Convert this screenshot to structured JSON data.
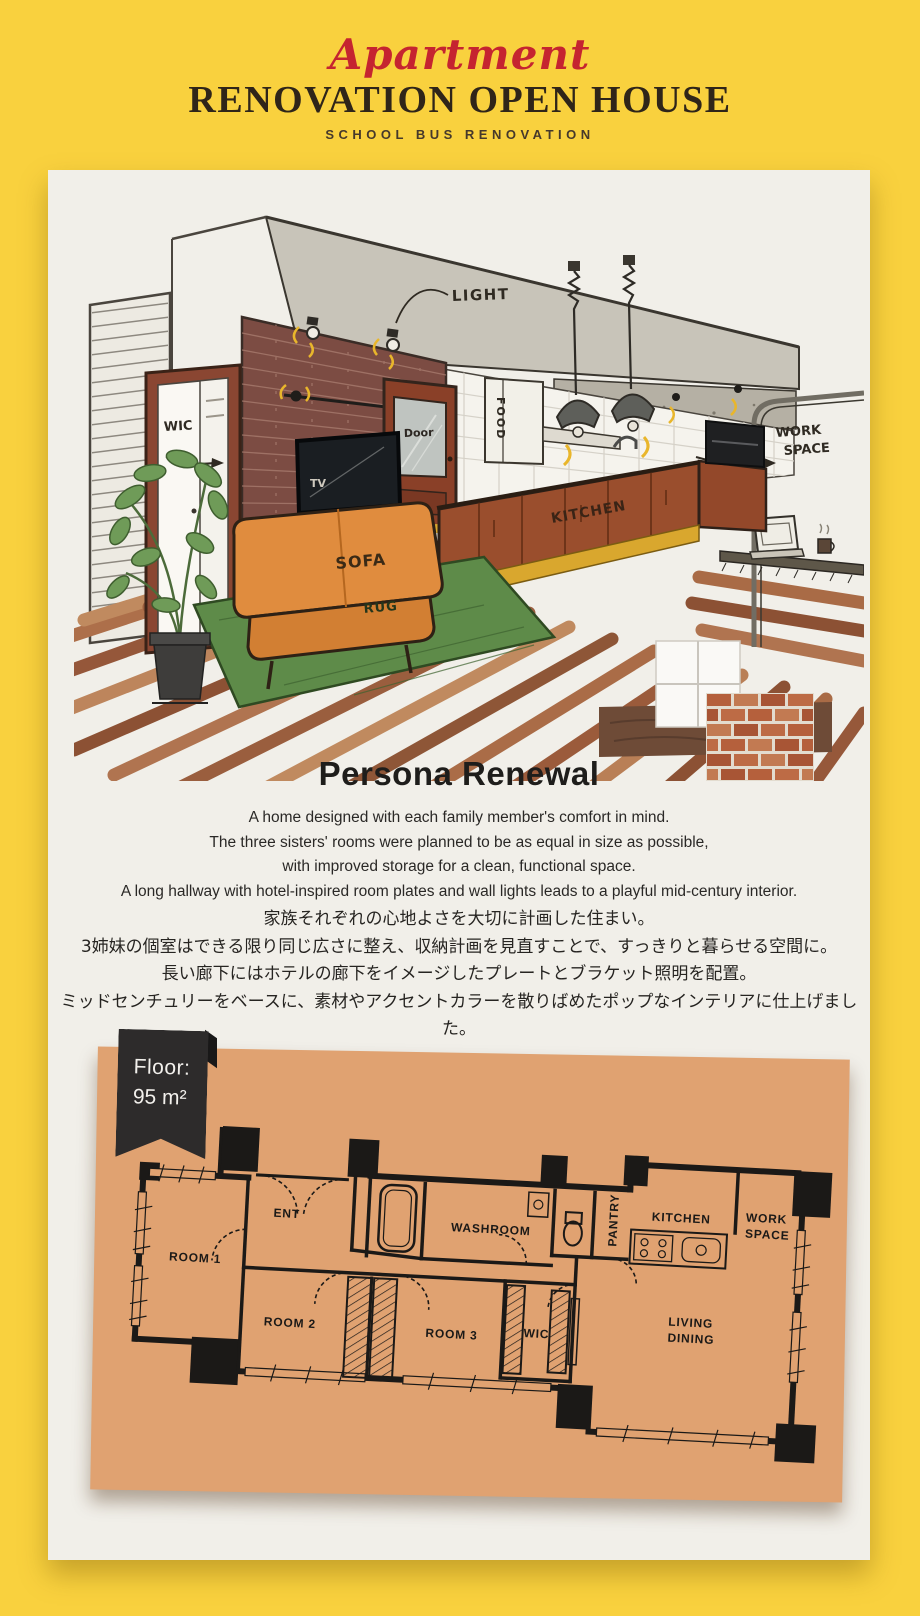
{
  "header": {
    "script_title": "Apartment",
    "main_title": "RENOVATION OPEN HOUSE",
    "sub_title": "SCHOOL BUS RENOVATION"
  },
  "intro": {
    "title": "Persona Renewal",
    "english_lines": [
      "A home designed with each family member's comfort in mind.",
      "The three sisters' rooms were planned to be as equal in size as possible,",
      "with improved storage for a clean, functional space.",
      "A long hallway with hotel-inspired room plates and wall lights leads to a playful mid-century interior."
    ],
    "japanese_lines": [
      "家族それぞれの心地よさを大切に計画した住まい。",
      "3姉妹の個室はできる限り同じ広さに整え、収納計画を見直すことで、すっきりと暮らせる空間に。",
      "長い廊下にはホテルの廊下をイメージしたプレートとブラケット照明を配置。",
      "ミッドセンチュリーをベースに、素材やアクセントカラーを散りばめたポップなインテリアに仕上げました。"
    ]
  },
  "illustration": {
    "labels": {
      "light": "LIGHT",
      "wic": "WIC",
      "door": "Door",
      "tv": "TV",
      "food": "FOOD",
      "kitchen": "KITCHEN",
      "sofa": "SOFA",
      "rug": "RUG",
      "work_space": [
        "WORK",
        "SPACE"
      ]
    }
  },
  "floor_plan": {
    "badge": {
      "label": "Floor:",
      "value": "95 m²"
    },
    "labels": {
      "room1": "ROOM 1",
      "room2": "ROOM 2",
      "room3": "ROOM 3",
      "ent": "ENT",
      "washroom": "WASHROOM",
      "pantry": "PANTRY",
      "kitchen": "KITCHEN",
      "work_space": [
        "WORK",
        "SPACE"
      ],
      "wic": "WIC",
      "living_dining": [
        "LIVING",
        "DINING"
      ]
    }
  },
  "colors": {
    "background": "#F9D13E",
    "paper": "#F1EFE9",
    "accent_red": "#C52430",
    "title_ink": "#2F2519",
    "body_ink": "#2A2826",
    "plan_paper": "#E0A271",
    "plan_ink": "#1B1917",
    "badge": "#2D2B2B",
    "sofa_orange": "#E08C3E",
    "rug_green": "#5E8B49",
    "cabinet_brown": "#9A4E2D",
    "gold_trim": "#D9A72E",
    "brick": "#7C4C43"
  }
}
